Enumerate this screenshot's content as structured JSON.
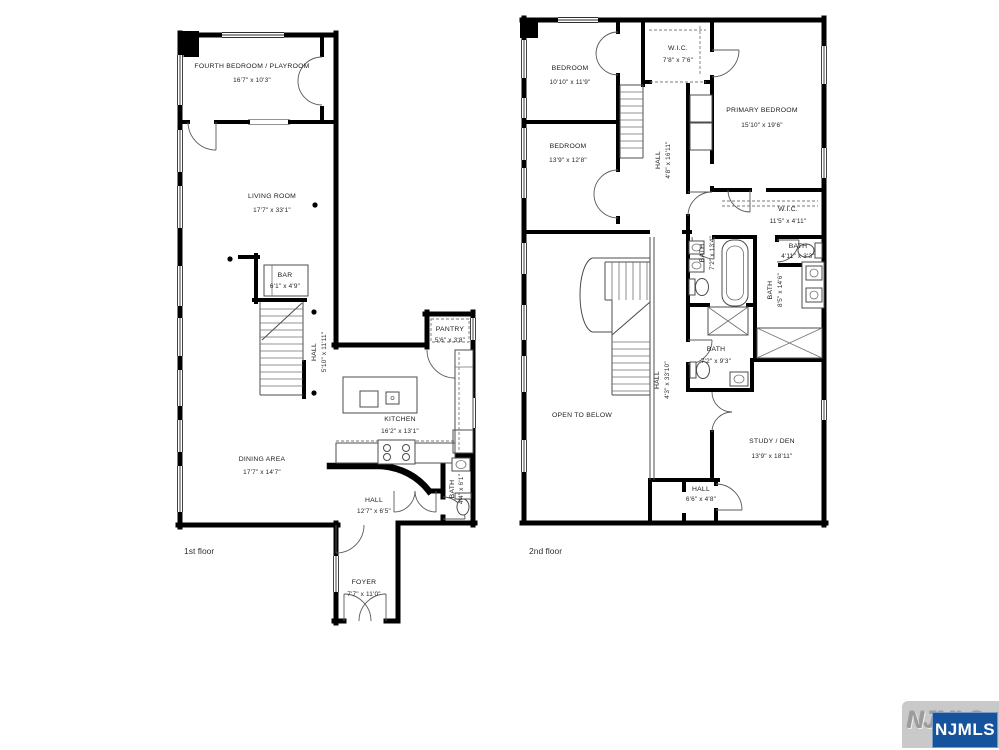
{
  "floor1": {
    "label": "1st floor",
    "rooms": {
      "fourth_bedroom": {
        "name": "FOURTH BEDROOM / PLAYROOM",
        "dims": "16'7\" x 10'3\""
      },
      "living_room": {
        "name": "LIVING ROOM",
        "dims": "17'7\" x 33'1\""
      },
      "bar": {
        "name": "BAR",
        "dims": "6'1\" x 4'9\""
      },
      "hall_stairs": {
        "name": "HALL",
        "dims": "5'10\" x 11'11\""
      },
      "pantry": {
        "name": "PANTRY",
        "dims": "5'6\" x 3'8\""
      },
      "kitchen": {
        "name": "KITCHEN",
        "dims": "16'2\" x 13'1\""
      },
      "dining": {
        "name": "DINING AREA",
        "dims": "17'7\" x 14'7\""
      },
      "hall": {
        "name": "HALL",
        "dims": "12'7\" x 6'5\""
      },
      "bath": {
        "name": "BATH",
        "dims": "4'4\" x 6'1\""
      },
      "foyer": {
        "name": "FOYER",
        "dims": "7'7\" x 11'0\""
      }
    }
  },
  "floor2": {
    "label": "2nd floor",
    "rooms": {
      "bedroom_top": {
        "name": "BEDROOM",
        "dims": "10'10\" x 11'9\""
      },
      "wic_top": {
        "name": "W.I.C.",
        "dims": "7'8\" x 7'6\""
      },
      "primary_bedroom": {
        "name": "PRIMARY BEDROOM",
        "dims": "15'10\" x 19'6\""
      },
      "bedroom_mid": {
        "name": "BEDROOM",
        "dims": "13'9\" x 12'8\""
      },
      "hall_upper": {
        "name": "HALL",
        "dims": "4'8\" x 16'11\""
      },
      "wic_primary": {
        "name": "W.I.C.",
        "dims": "11'5\" x 4'11\""
      },
      "bath_primary": {
        "name": "BATH",
        "dims": "7'2\" x 13'4\""
      },
      "bath_toilet": {
        "name": "BATH",
        "dims": "4'11\" x 3'3\""
      },
      "bath_double": {
        "name": "BATH",
        "dims": "8'5\" x 14'6\""
      },
      "bath_hall": {
        "name": "BATH",
        "dims": "7'2\" x 9'3\""
      },
      "hall_main": {
        "name": "HALL",
        "dims": "4'3\" x 33'10\""
      },
      "open_below": {
        "name": "OPEN TO BELOW"
      },
      "study": {
        "name": "STUDY / DEN",
        "dims": "13'9\" x 18'11\""
      },
      "hall_small": {
        "name": "HALL",
        "dims": "6'6\" x 4'8\""
      }
    }
  },
  "watermark": {
    "logo_text": "NJMLS",
    "badge_text": "NJMLS",
    "badge_color": "#15549c"
  }
}
